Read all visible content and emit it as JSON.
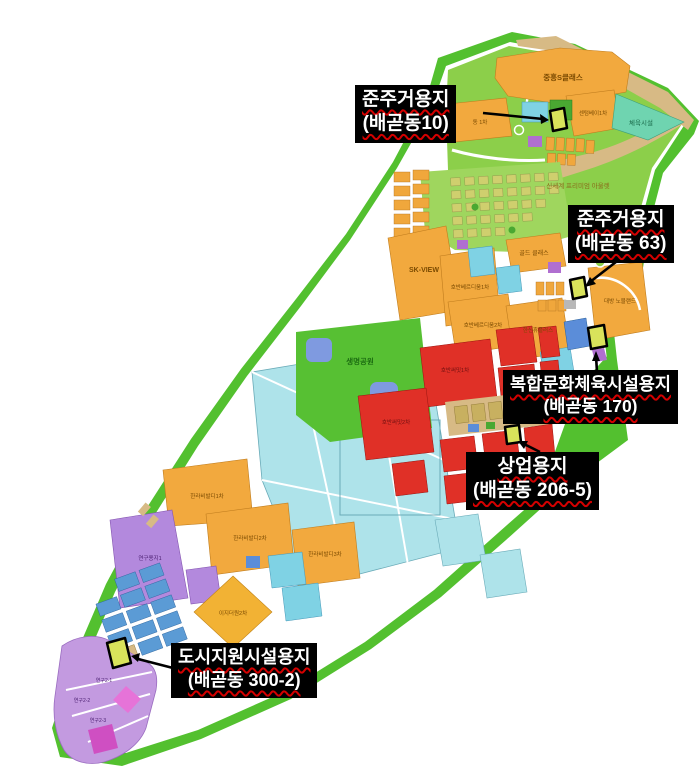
{
  "title": "배곧 토지이용계획 안내도",
  "callouts": [
    {
      "id": "c1",
      "line1": "준주거용지",
      "line2": "(배곧동10)"
    },
    {
      "id": "c2",
      "line1": "준주거용지",
      "line2": "(배곧동 63)"
    },
    {
      "id": "c3",
      "line1": "복합문화체육시설용지",
      "line2": "(배곧동 170)"
    },
    {
      "id": "c4",
      "line1": "상업용지",
      "line2": "(배곧동 206-5)"
    },
    {
      "id": "c5",
      "line1": "도시지원시설용지",
      "line2": "(배곧동 300-2)"
    }
  ],
  "map_labels": {
    "jungheung_s_class": "중흥S클래스",
    "centum_bay_1": "센텀베이1차",
    "dong_1cha": "동 1차",
    "sports_facility": "체육시설",
    "shinsegae_outlet": "신세계 프리미엄 아울렛",
    "sk_view": "SK-VIEW",
    "gold_class": "골드 클래스",
    "hoban_verdium_1": "호반베르디움1차",
    "hoban_verdium_2": "호반베르디움2차",
    "hanshin_hue_plus": "한신휴플러스",
    "daebang_nobleland": "대방 노블랜드",
    "life_park": "생명공원",
    "hoban_summit_1": "호반써밋1차",
    "hoban_summit_2": "호반써밋2차",
    "halla_vivaldi_1": "한라비발디1차",
    "halla_vivaldi_2": "한라비발디2차",
    "halla_vivaldi_3": "한라비발디3차",
    "research_site_1": "연구용지1",
    "ezone_the1_2": "이지더원2차",
    "research_2_1": "연구2-1",
    "research_2_2": "연구2-2",
    "research_2_3": "연구2-3"
  },
  "colors": {
    "callout_bg": "#000000",
    "callout_text": "#ffffff",
    "underline_squiggle": "#d40000",
    "highlight_parcel": "#d9e35b",
    "residential_orange": "#f2a93e",
    "commercial_red": "#e03027",
    "education_cyan": "#aee3ea",
    "school_cyan": "#7fd2e4",
    "boundary_green": "#53c02f",
    "park_green": "#8ccf4a",
    "research_purple": "#b389dd",
    "road_tan": "#d7ba85",
    "public_blue": "#5b8dd9"
  }
}
